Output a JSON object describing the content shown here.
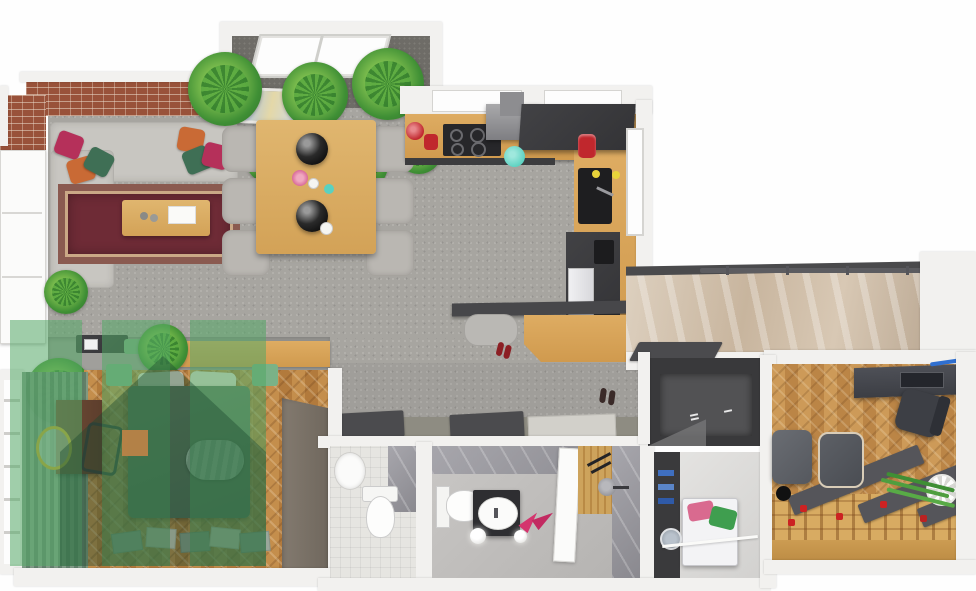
{
  "meta": {
    "title": "3D rendered top-down apartment floor plan",
    "render_style": "photorealistic 3D floor plan, bird's-eye view",
    "canvas": {
      "width": 976,
      "height": 591
    },
    "visible_text": "none"
  },
  "palette": {
    "background_white": "#fefefe",
    "wall_white": "#f2f1ef",
    "floor_concrete_gray": "#a7a5a0",
    "alcove_dark_gray": "#6e6c67",
    "brick_terracotta": "#99523a",
    "parquet_herringbone": "#bf8845",
    "office_parquet": "#c79454",
    "counter_wood": "#d9a55c",
    "cabinet_dark_gray": "#3b3b3d",
    "sofa_gray": "#c8c6c1",
    "rug_dark_red": "#6e2b36",
    "bedding_sage_green": "#5a7360",
    "marble_beige": "#d0bfa9",
    "bathroom_marble_gray": "#96959b",
    "watermark_green": "#53a866",
    "accent_magenta": "#b5305a",
    "accent_orange": "#c96a35",
    "accent_forest_green": "#3f6f55",
    "accent_red_appliance": "#c0272d",
    "accent_teal": "#5ad1c0",
    "accent_pink_slippers": "#d4356e",
    "accent_yellow_lemons": "#e8d33a"
  },
  "watermark": {
    "shape": "house-logo with three vertical bars and gabled-roof silhouette",
    "color": "#53a866",
    "opacity": 0.55,
    "position": "bottom-left quadrant over bedroom"
  },
  "rooms": {
    "living": {
      "name": "Living room",
      "floor": "gray concrete",
      "furniture": [
        "L-shaped gray corner sofa",
        "colorful throw pillows (magenta, orange, green)",
        "oriental dark-red rug",
        "wooden coffee table with tray",
        "abstract wall art leaning on brick wall",
        "terracotta brick walls",
        "white window doors on left wall",
        "dark TV sideboard"
      ]
    },
    "alcove": {
      "name": "Plant alcove",
      "floor": "dark gray",
      "furniture": [
        "roof window",
        "row of potted green plants (palms, monstera)"
      ]
    },
    "dining": {
      "name": "Dining area",
      "furniture": [
        "rectangular wooden table",
        "six gray upholstered chairs",
        "two black pendant lamps",
        "pink flowers",
        "teal cup",
        "white cups"
      ]
    },
    "kitchen": {
      "name": "Kitchen",
      "furniture": [
        "L-shaped wooden countertop",
        "black four-burner cooktop",
        "gray extractor hood",
        "dark gray upper cabinets",
        "black sink with faucet",
        "tall dark oven/fridge column with white fridge front",
        "red kettle",
        "red stand mixer",
        "teal bowl",
        "yellow lemons",
        "window on right wall"
      ]
    },
    "hallway": {
      "name": "Hallway",
      "furniture": [
        "dark gray doormats",
        "light doormat",
        "gray pouf",
        "wooden shoe bench",
        "red shoes",
        "dark wall-mounted shelf"
      ]
    },
    "landing": {
      "name": "Entrance landing / stairwell",
      "furniture": [
        "beige marble wall",
        "dark gray railing with posts",
        "dark doormat"
      ]
    },
    "bedroom": {
      "name": "Bedroom",
      "floor": "herringbone parquet",
      "furniture": [
        "double bed with dark sage-green bedding",
        "light green folded throw",
        "white pillows",
        "green nightstands",
        "tall dark wardrobe",
        "dark brown vanity dresser",
        "round gold mirror",
        "chair",
        "sage pleated curtains along window wall",
        "scattered papers/mats on floor",
        "wooden headboard shelf"
      ]
    },
    "wc": {
      "name": "Guest WC",
      "furniture": [
        "white washbasin",
        "white toilet",
        "light tiled floor",
        "gray marble wall"
      ]
    },
    "bathroom": {
      "name": "Bathroom",
      "furniture": [
        "white toilet",
        "dark vanity with white oval basin",
        "pink slippers",
        "two white sphere floor lamps",
        "walk-in shower with wood slat wall and round shower head",
        "open white door",
        "gray marble walls"
      ]
    },
    "closet": {
      "name": "Walk-in closet",
      "furniture": [
        "dark gray shelving walls",
        "dark carpet"
      ]
    },
    "laundry": {
      "name": "Laundry room",
      "furniture": [
        "white washing machine with round door",
        "dark shelving unit",
        "pink towels",
        "green towels",
        "white rail"
      ]
    },
    "office": {
      "name": "Home office / studio",
      "floor": "herringbone parquet with raised wooden platform",
      "furniture": [
        "dark desk with laptop and blue cable",
        "black office chair",
        "gray lounge chair",
        "tufted gray ottoman",
        "black floor lamp",
        "wooden platform bed frame under construction",
        "three dark gray runners",
        "scattered red tools",
        "palm plant in white pot"
      ]
    }
  }
}
